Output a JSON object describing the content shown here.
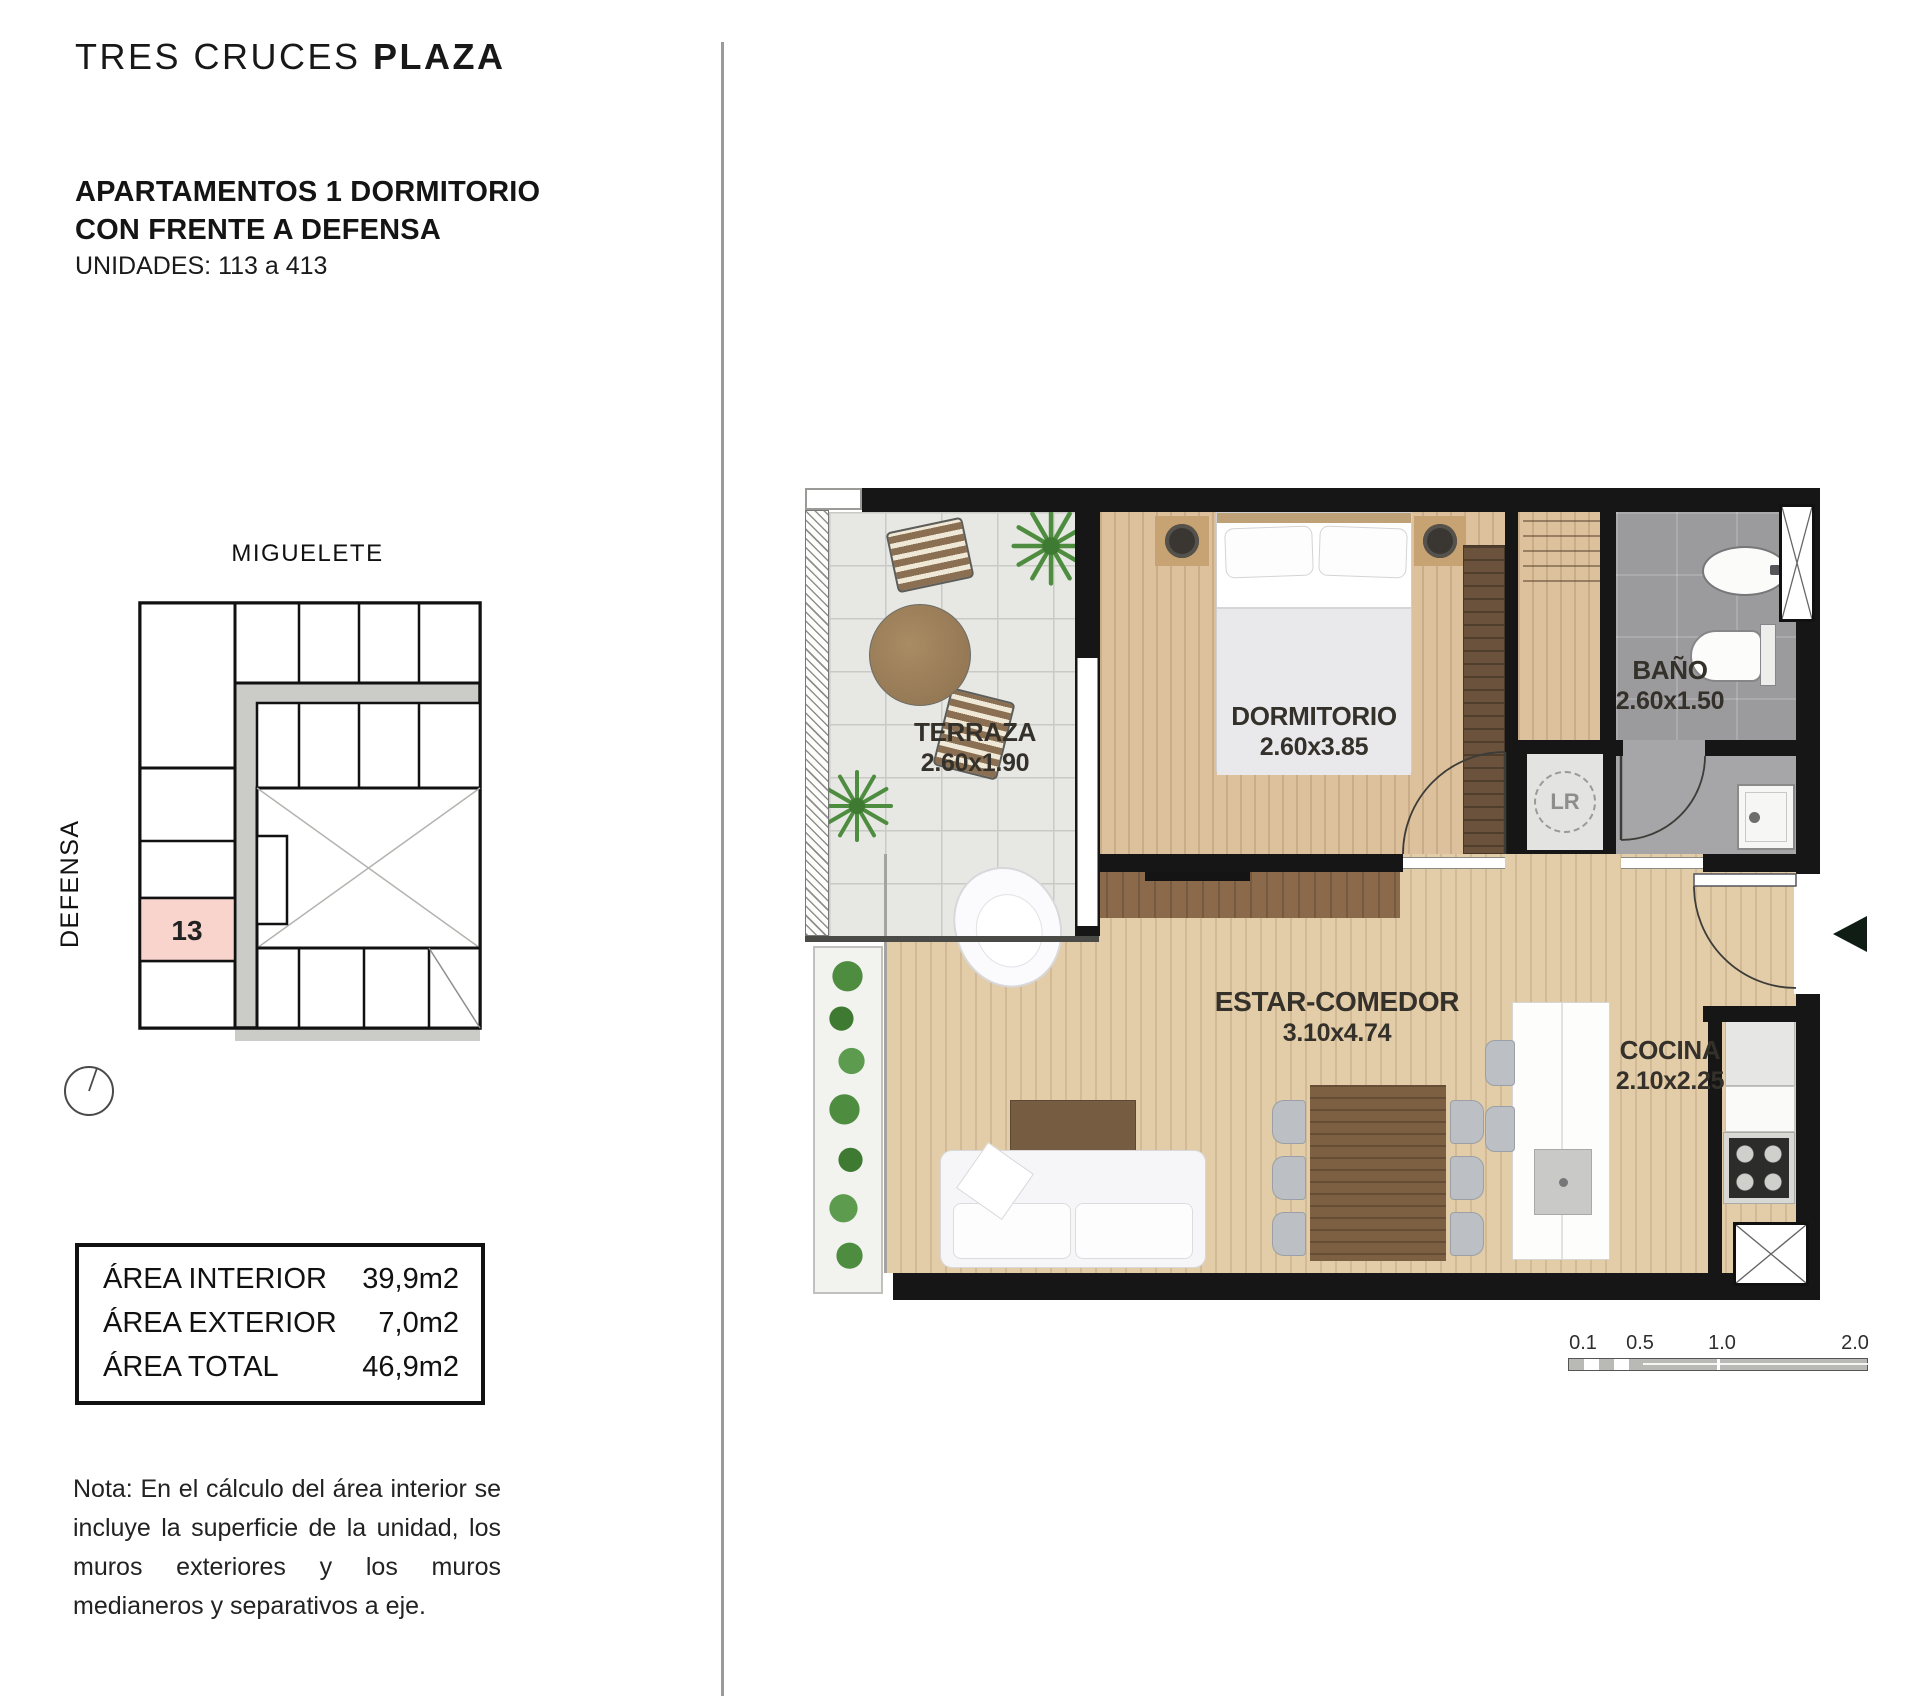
{
  "header": {
    "brand_regular": "TRES CRUCES ",
    "brand_bold": "PLAZA",
    "title_line1": "APARTAMENTOS 1 DORMITORIO",
    "title_line2": "CON FRENTE A DEFENSA",
    "units": "UNIDADES: 113 a 413"
  },
  "key_plan": {
    "street_top": "MIGUELETE",
    "street_left": "DEFENSA",
    "highlight_unit": "13"
  },
  "areas": {
    "rows": [
      {
        "label": "ÁREA INTERIOR",
        "value": "39,9m2"
      },
      {
        "label": "ÁREA EXTERIOR",
        "value": "7,0m2"
      },
      {
        "label": "ÁREA TOTAL",
        "value": "46,9m2"
      }
    ]
  },
  "note": "Nota: En el cálculo del área interior se incluye la superficie de la unidad, los muros exteriores y los muros medianeros y separativos a eje.",
  "rooms": {
    "terraza": {
      "name": "TERRAZA",
      "dims": "2.60x1.90"
    },
    "dormitorio": {
      "name": "DORMITORIO",
      "dims": "2.60x3.85"
    },
    "bano": {
      "name": "BAÑO",
      "dims": "2.60x1.50"
    },
    "estar": {
      "name": "ESTAR-COMEDOR",
      "dims": "3.10x4.74"
    },
    "cocina": {
      "name": "COCINA",
      "dims": "2.10x2.25"
    },
    "laundry": "LR"
  },
  "scale_bar": {
    "labels": [
      "0.1",
      "0.5",
      "1.0",
      "2.0"
    ]
  },
  "colors": {
    "wall": "#161616",
    "highlight_pink": "#f8d4cd",
    "wood_floor": "#dcc19c",
    "terrace_tile": "#e7e7e4",
    "bath_tile": "#9b9b9d",
    "plant_green": "#4e8c3f"
  }
}
